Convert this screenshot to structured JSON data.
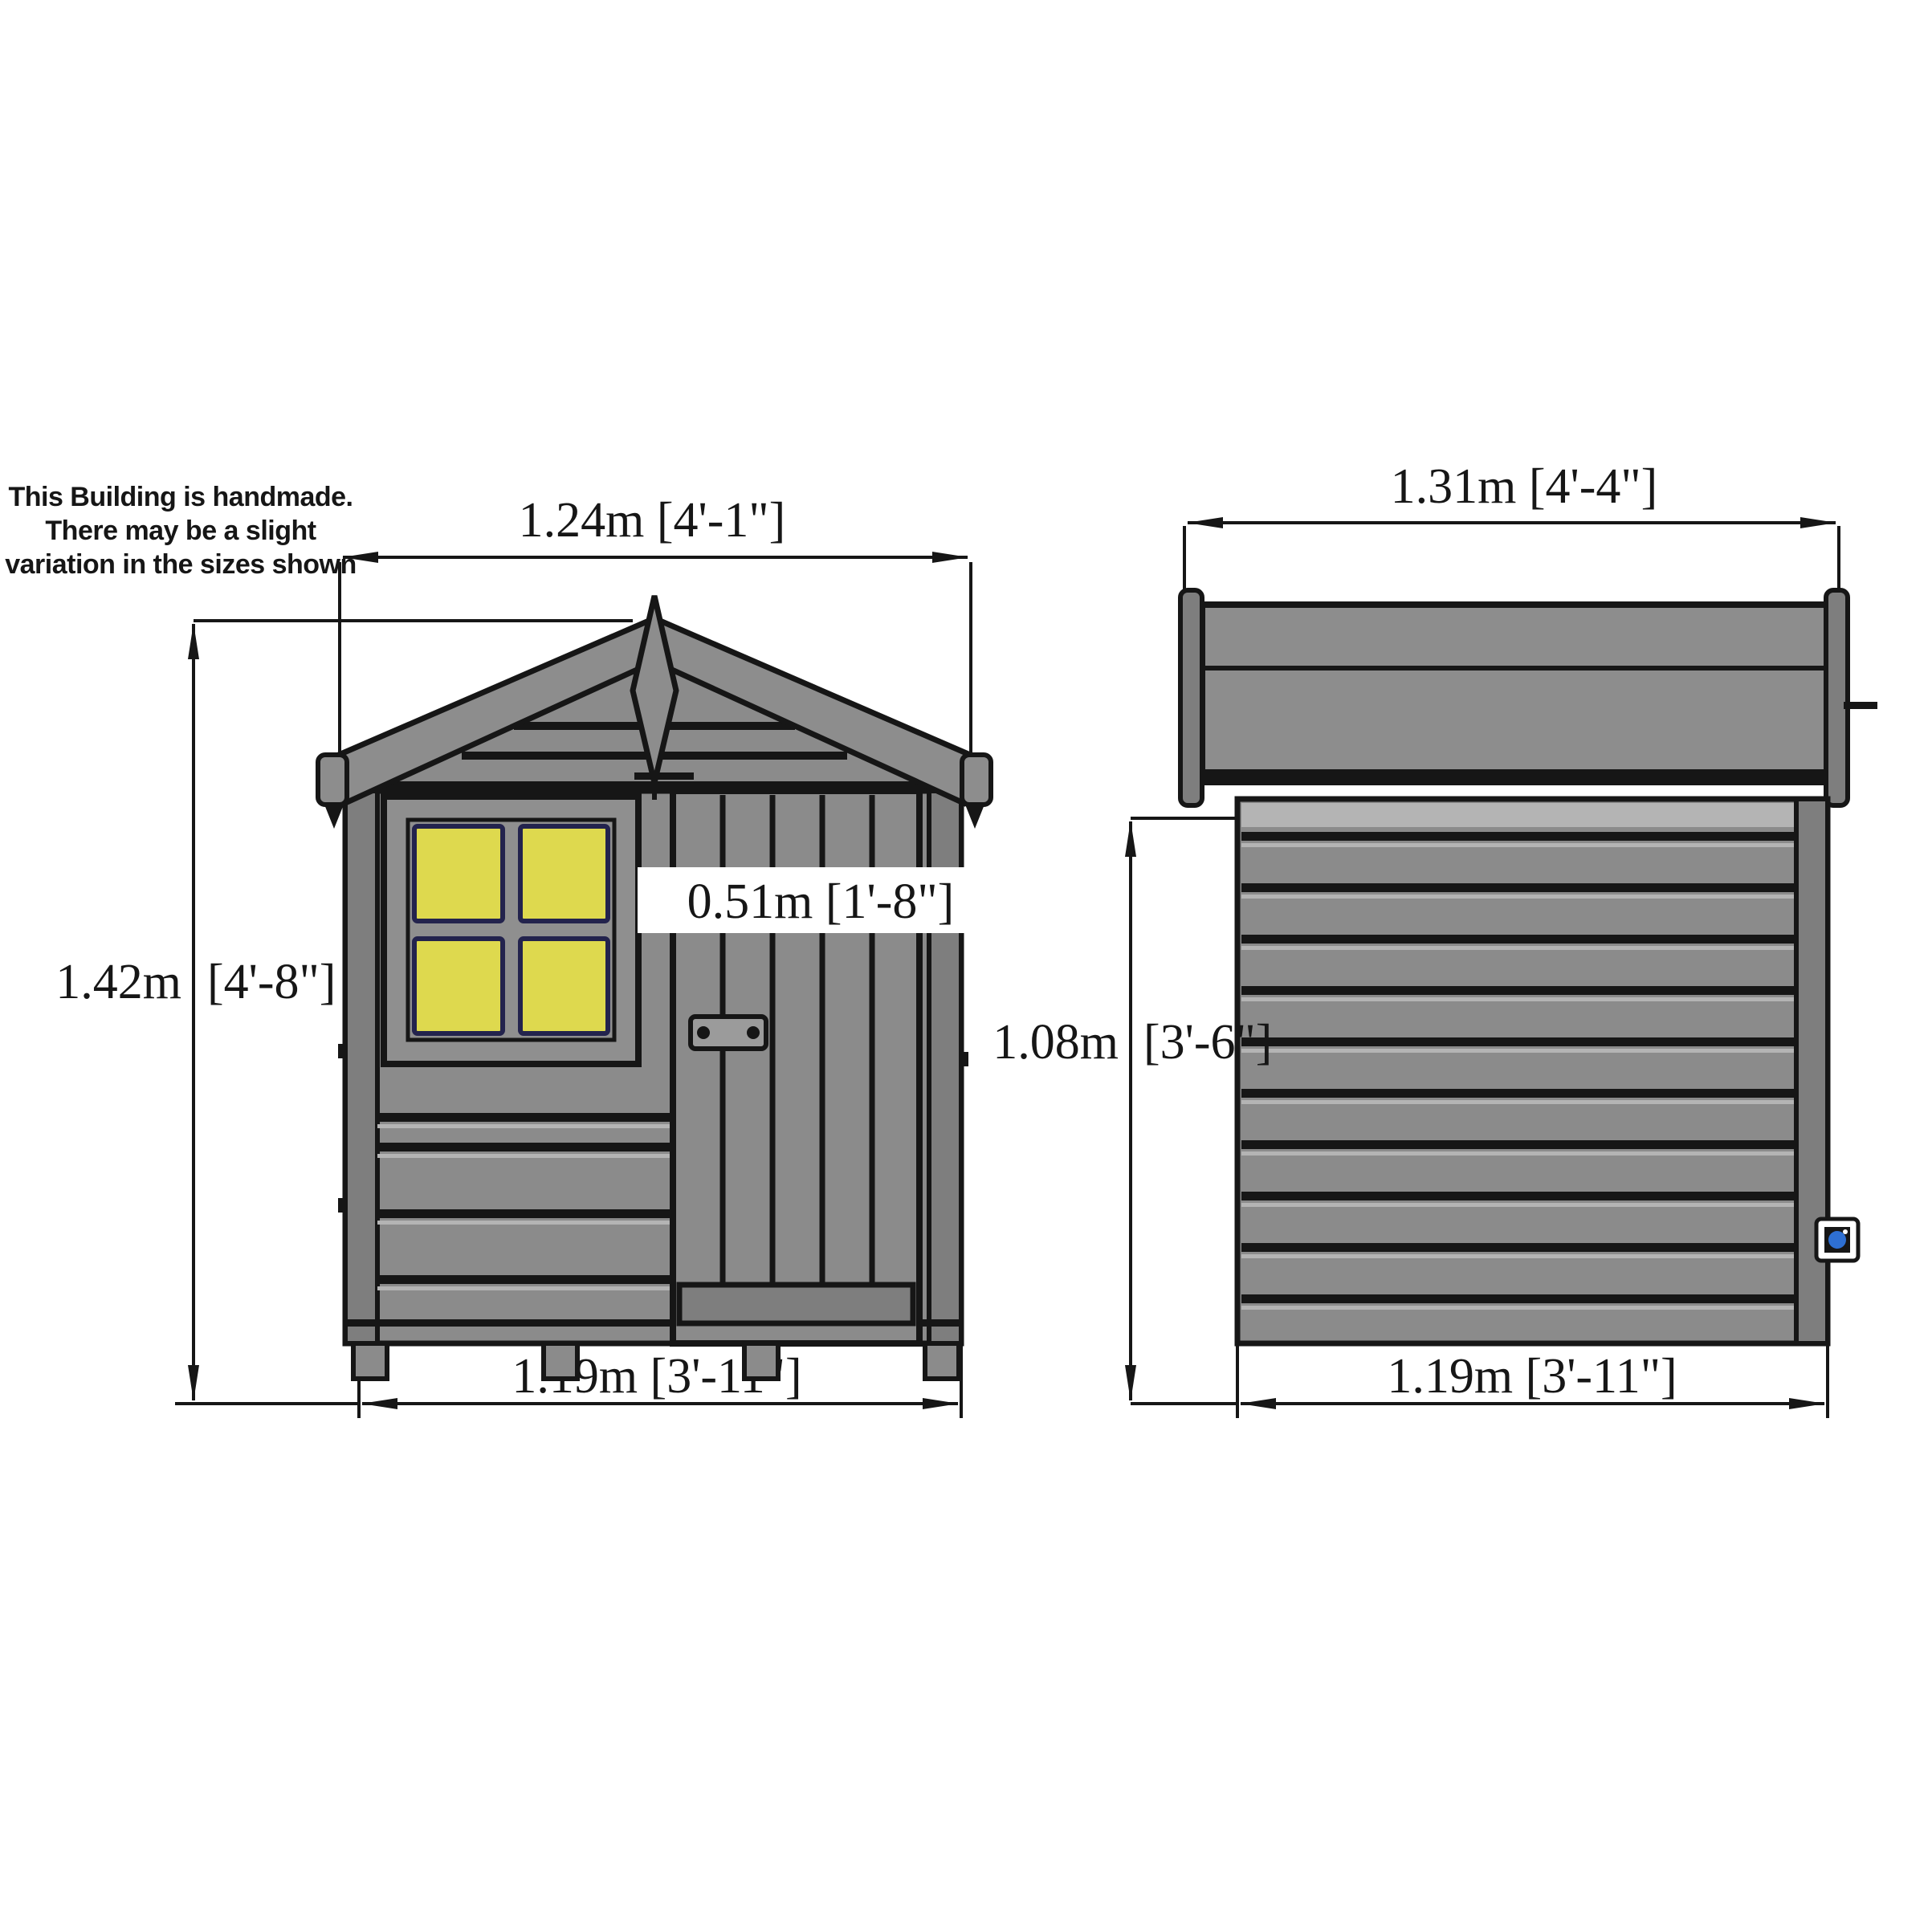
{
  "disclaimer": {
    "lines": [
      "This Building is handmade.",
      "There may be a slight",
      "variation in the sizes shown"
    ]
  },
  "front_view": {
    "roof_width_label": "1.24m [4'-1\"]",
    "overall_height_label_m": "1.42m",
    "overall_height_label_ft": "[4'-8\"]",
    "door_width_label": "0.51m [1'-8\"]",
    "base_width_label": "1.19m [3'-11\"]"
  },
  "side_view": {
    "roof_depth_label": "1.31m [4'-4\"]",
    "eaves_height_label_m": "1.08m",
    "eaves_height_label_ft": "[3'-6\"]",
    "base_depth_label": "1.19m [3'-11\"]"
  },
  "colors": {
    "ink": "#161616",
    "wall_grey": "#8b8b8b",
    "wall_light_grey": "#b4b4b4",
    "trim_grey": "#7e7e7e",
    "roof_grey": "#8d8d8d",
    "window_yellow": "#ded94e",
    "window_pane_edge": "#23234d",
    "plaque_blue": "#2e6fd2",
    "background": "#ffffff"
  }
}
